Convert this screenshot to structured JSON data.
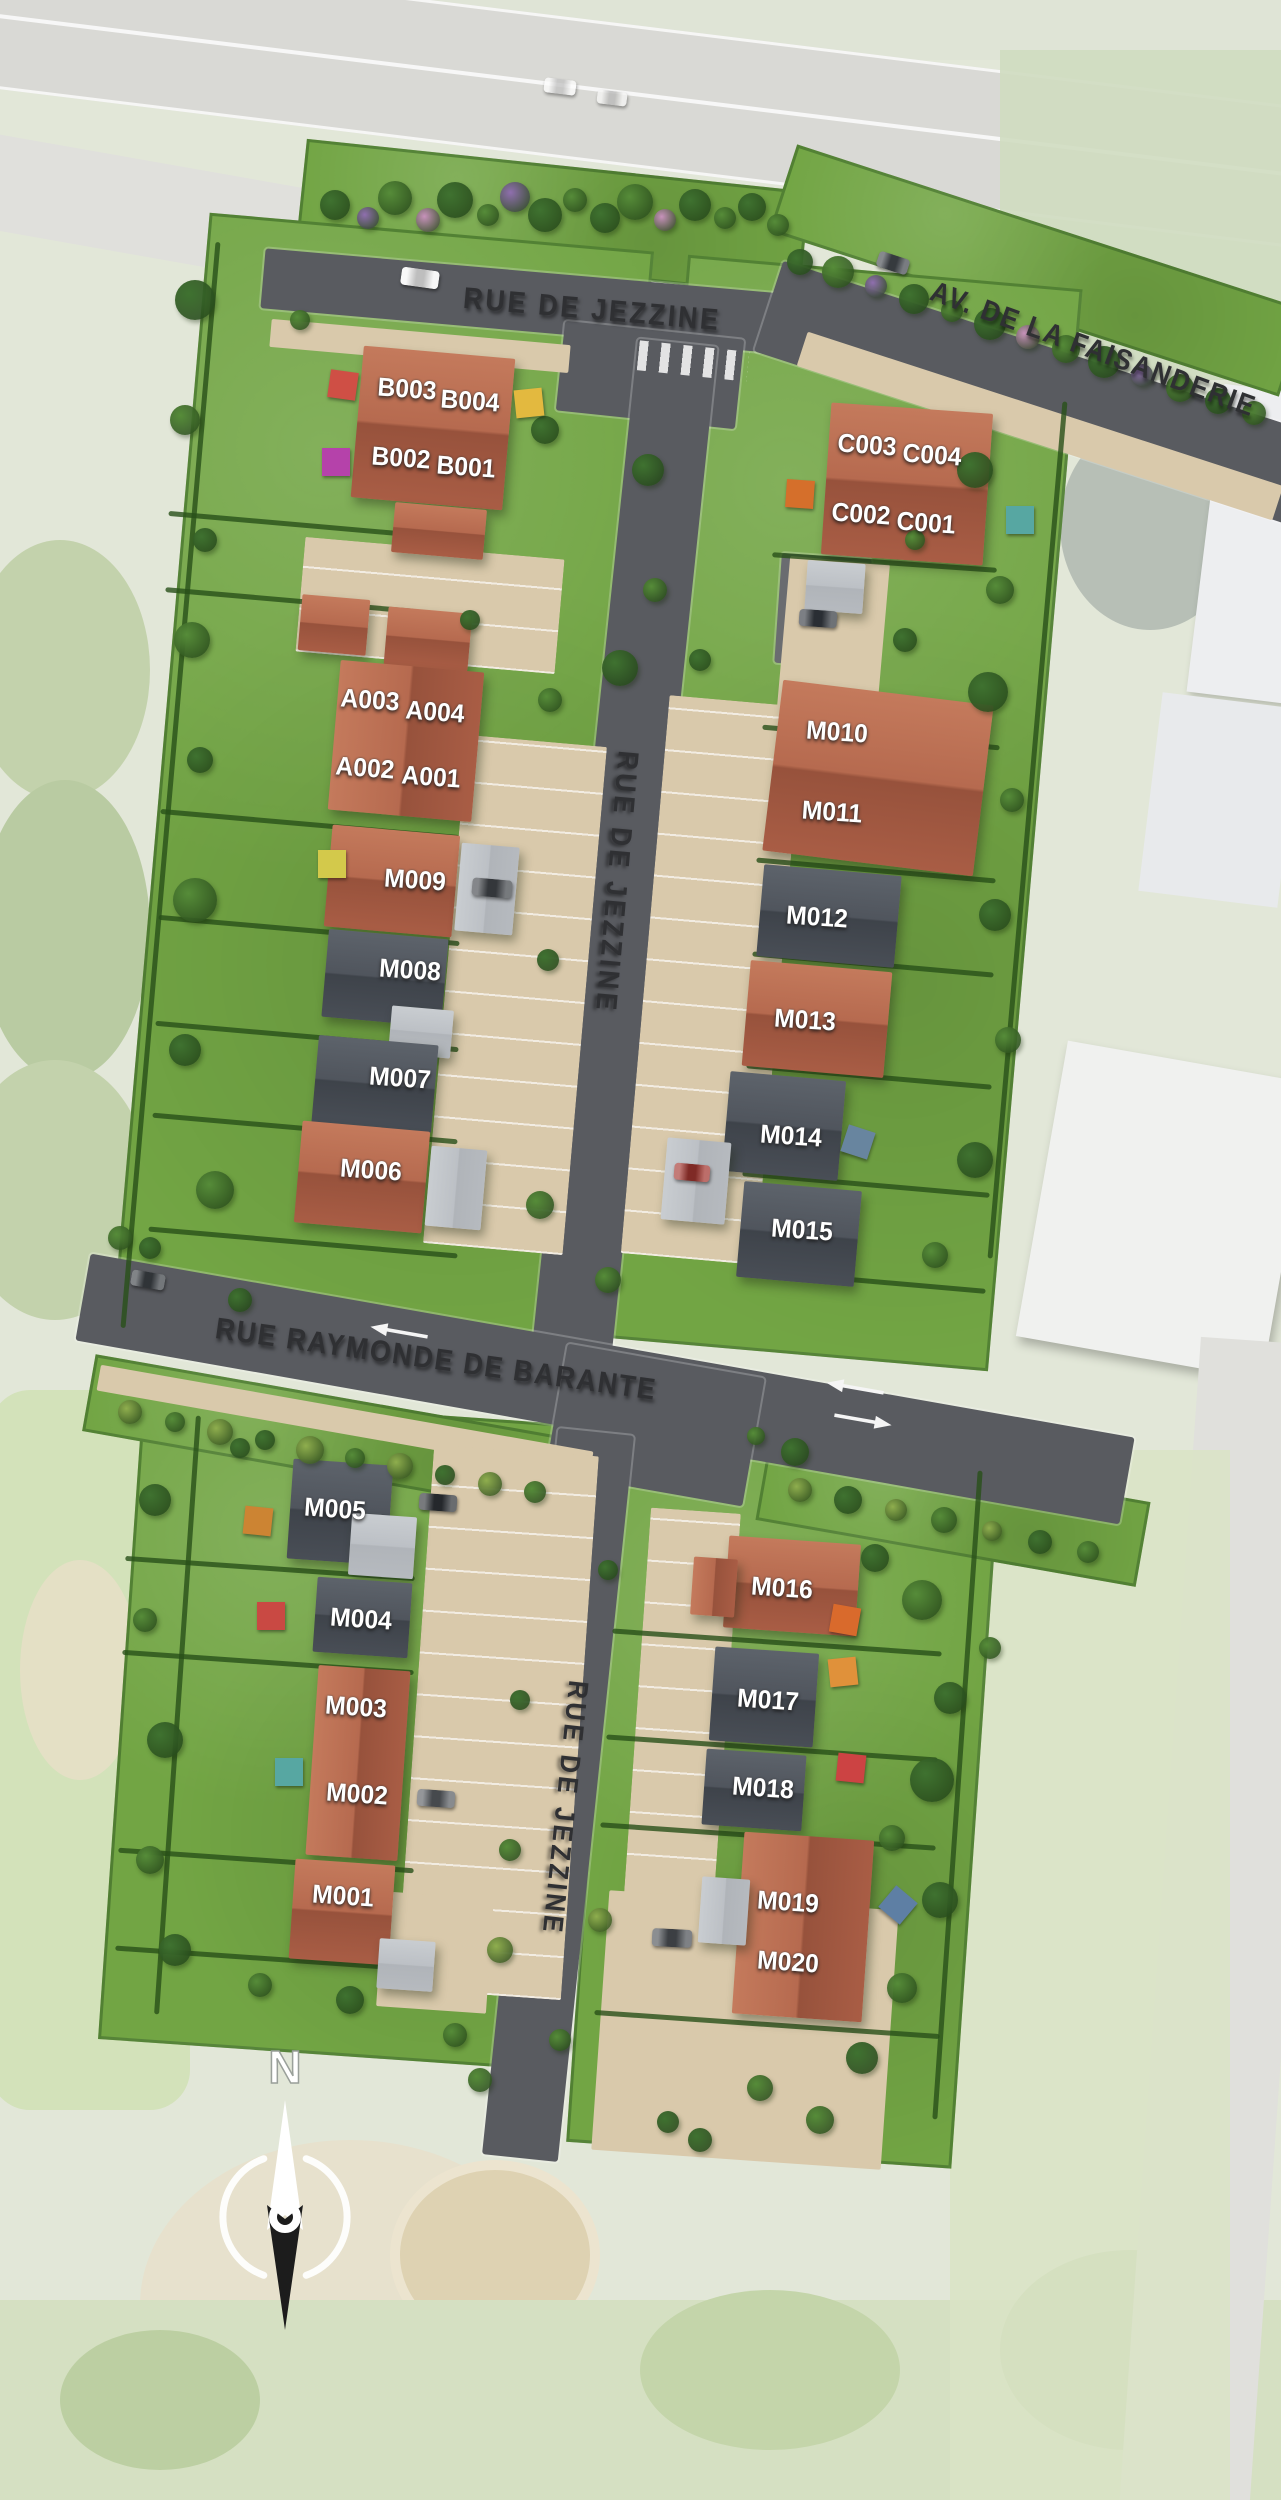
{
  "streets": [
    {
      "id": "rue-de-jezzine-top",
      "label": "RUE DE JEZZINE",
      "x": 592,
      "y": 310,
      "rot": 5,
      "size": 30,
      "ls": 3
    },
    {
      "id": "av-de-la-faisanderie",
      "label": "AV. DE LA  FAISANDERIE",
      "x": 1093,
      "y": 350,
      "rot": 20,
      "size": 29,
      "ls": 2
    },
    {
      "id": "rue-de-jezzine-upper",
      "label": "RUE DE JEZZINE",
      "x": 616,
      "y": 882,
      "rot": 95,
      "size": 29,
      "ls": 4
    },
    {
      "id": "rue-raymonde-de-barante",
      "label": "RUE RAYMONDE DE BARANTE",
      "x": 436,
      "y": 1360,
      "rot": 8,
      "size": 30,
      "ls": 2
    },
    {
      "id": "rue-de-jezzine-lower",
      "label": "RUE DE JEZZINE",
      "x": 565,
      "y": 1808,
      "rot": 96,
      "size": 28,
      "ls": 4
    }
  ],
  "lots": [
    {
      "id": "B003",
      "x": 407,
      "y": 389
    },
    {
      "id": "B004",
      "x": 470,
      "y": 401
    },
    {
      "id": "B002",
      "x": 401,
      "y": 458
    },
    {
      "id": "B001",
      "x": 466,
      "y": 467
    },
    {
      "id": "C003",
      "x": 867,
      "y": 445
    },
    {
      "id": "C004",
      "x": 932,
      "y": 455
    },
    {
      "id": "C002",
      "x": 861,
      "y": 514
    },
    {
      "id": "C001",
      "x": 926,
      "y": 523
    },
    {
      "id": "A003",
      "x": 370,
      "y": 700
    },
    {
      "id": "A004",
      "x": 435,
      "y": 712
    },
    {
      "id": "A002",
      "x": 365,
      "y": 768
    },
    {
      "id": "A001",
      "x": 431,
      "y": 777
    },
    {
      "id": "M010",
      "x": 837,
      "y": 732
    },
    {
      "id": "M011",
      "x": 832,
      "y": 812
    },
    {
      "id": "M009",
      "x": 415,
      "y": 880
    },
    {
      "id": "M008",
      "x": 410,
      "y": 970
    },
    {
      "id": "M012",
      "x": 817,
      "y": 917
    },
    {
      "id": "M013",
      "x": 805,
      "y": 1020
    },
    {
      "id": "M007",
      "x": 400,
      "y": 1078
    },
    {
      "id": "M006",
      "x": 371,
      "y": 1170
    },
    {
      "id": "M014",
      "x": 791,
      "y": 1136
    },
    {
      "id": "M015",
      "x": 802,
      "y": 1230
    },
    {
      "id": "M005",
      "x": 335,
      "y": 1509
    },
    {
      "id": "M004",
      "x": 361,
      "y": 1619
    },
    {
      "id": "M003",
      "x": 356,
      "y": 1707
    },
    {
      "id": "M002",
      "x": 357,
      "y": 1794
    },
    {
      "id": "M001",
      "x": 343,
      "y": 1896
    },
    {
      "id": "M016",
      "x": 782,
      "y": 1588
    },
    {
      "id": "M017",
      "x": 768,
      "y": 1700
    },
    {
      "id": "M018",
      "x": 763,
      "y": 1788
    },
    {
      "id": "M019",
      "x": 788,
      "y": 1902
    },
    {
      "id": "M020",
      "x": 788,
      "y": 1962
    }
  ],
  "buildings": [
    {
      "id": "B",
      "x": 357,
      "y": 352,
      "w": 152,
      "h": 152,
      "t": "terra",
      "r": 5
    },
    {
      "id": "B-garage",
      "x": 393,
      "y": 506,
      "w": 92,
      "h": 50,
      "t": "terra",
      "r": 5
    },
    {
      "id": "A-annex-1",
      "x": 300,
      "y": 597,
      "w": 68,
      "h": 56,
      "t": "terra",
      "r": 5
    },
    {
      "id": "A-annex-2",
      "x": 386,
      "y": 610,
      "w": 84,
      "h": 58,
      "t": "terra",
      "r": 5
    },
    {
      "id": "A",
      "x": 334,
      "y": 666,
      "w": 144,
      "h": 150,
      "t": "terra",
      "r": 5
    },
    {
      "id": "M009",
      "x": 328,
      "y": 830,
      "w": 128,
      "h": 102,
      "t": "terra",
      "r": 5
    },
    {
      "id": "M009-carport",
      "x": 458,
      "y": 845,
      "w": 58,
      "h": 88,
      "t": "annex",
      "r": 5
    },
    {
      "id": "M008",
      "x": 325,
      "y": 934,
      "w": 120,
      "h": 88,
      "t": "slate",
      "r": 5
    },
    {
      "id": "M008-link",
      "x": 390,
      "y": 1008,
      "w": 62,
      "h": 48,
      "t": "annex",
      "r": 5
    },
    {
      "id": "M007",
      "x": 315,
      "y": 1040,
      "w": 120,
      "h": 88,
      "t": "slate",
      "r": 5
    },
    {
      "id": "M006",
      "x": 298,
      "y": 1126,
      "w": 128,
      "h": 102,
      "t": "terra",
      "r": 5
    },
    {
      "id": "M006-carport",
      "x": 428,
      "y": 1148,
      "w": 56,
      "h": 80,
      "t": "annex",
      "r": 5
    },
    {
      "id": "C",
      "x": 826,
      "y": 408,
      "w": 162,
      "h": 152,
      "t": "terra",
      "r": 4
    },
    {
      "id": "C-carport",
      "x": 806,
      "y": 562,
      "w": 58,
      "h": 50,
      "t": "annex",
      "r": 4
    },
    {
      "id": "M010-M011",
      "x": 772,
      "y": 692,
      "w": 212,
      "h": 172,
      "t": "terra",
      "r": 7
    },
    {
      "id": "M012",
      "x": 760,
      "y": 870,
      "w": 138,
      "h": 92,
      "t": "slate",
      "r": 5
    },
    {
      "id": "M013",
      "x": 746,
      "y": 966,
      "w": 142,
      "h": 106,
      "t": "terra",
      "r": 5
    },
    {
      "id": "M014",
      "x": 726,
      "y": 1076,
      "w": 116,
      "h": 100,
      "t": "slate",
      "r": 5
    },
    {
      "id": "M014-carport",
      "x": 664,
      "y": 1140,
      "w": 64,
      "h": 82,
      "t": "annex",
      "r": 5
    },
    {
      "id": "M015",
      "x": 740,
      "y": 1186,
      "w": 118,
      "h": 96,
      "t": "slate",
      "r": 5
    },
    {
      "id": "M005",
      "x": 290,
      "y": 1462,
      "w": 100,
      "h": 100,
      "t": "slate",
      "r": 4
    },
    {
      "id": "M005-link",
      "x": 350,
      "y": 1515,
      "w": 65,
      "h": 62,
      "t": "annex",
      "r": 4
    },
    {
      "id": "M004",
      "x": 315,
      "y": 1580,
      "w": 95,
      "h": 75,
      "t": "slate",
      "r": 4
    },
    {
      "id": "M003-M002",
      "x": 312,
      "y": 1668,
      "w": 92,
      "h": 190,
      "t": "terra",
      "r": 4
    },
    {
      "id": "M001",
      "x": 292,
      "y": 1862,
      "w": 100,
      "h": 100,
      "t": "terra",
      "r": 4
    },
    {
      "id": "M001-link",
      "x": 378,
      "y": 1940,
      "w": 56,
      "h": 50,
      "t": "annex",
      "r": 4
    },
    {
      "id": "M016",
      "x": 726,
      "y": 1540,
      "w": 132,
      "h": 92,
      "t": "terra",
      "r": 4
    },
    {
      "id": "M016-garage",
      "x": 692,
      "y": 1558,
      "w": 44,
      "h": 58,
      "t": "terra",
      "r": 4
    },
    {
      "id": "M017",
      "x": 712,
      "y": 1650,
      "w": 104,
      "h": 94,
      "t": "slate",
      "r": 4
    },
    {
      "id": "M018",
      "x": 704,
      "y": 1752,
      "w": 100,
      "h": 76,
      "t": "slate",
      "r": 4
    },
    {
      "id": "M019-M020",
      "x": 738,
      "y": 1836,
      "w": 130,
      "h": 182,
      "t": "terra",
      "r": 4
    },
    {
      "id": "M019-garage",
      "x": 700,
      "y": 1878,
      "w": 48,
      "h": 66,
      "t": "annex",
      "r": 4
    }
  ],
  "parasols": [
    {
      "x": 343,
      "y": 385,
      "c": "#cf4f45",
      "r": 8
    },
    {
      "x": 529,
      "y": 403,
      "c": "#e3b93f",
      "r": -6
    },
    {
      "x": 336,
      "y": 462,
      "c": "#b542aa",
      "r": 0
    },
    {
      "x": 800,
      "y": 494,
      "c": "#d56f2b",
      "r": 4
    },
    {
      "x": 1020,
      "y": 520,
      "c": "#57a7a2",
      "r": 0
    },
    {
      "x": 332,
      "y": 864,
      "c": "#d3c94b",
      "r": 0
    },
    {
      "x": 858,
      "y": 1142,
      "c": "#68859f",
      "r": 18
    },
    {
      "x": 258,
      "y": 1521,
      "c": "#cc8433",
      "r": 6
    },
    {
      "x": 271,
      "y": 1616,
      "c": "#c94943",
      "r": 0
    },
    {
      "x": 289,
      "y": 1772,
      "c": "#57a7a2",
      "r": 0
    },
    {
      "x": 845,
      "y": 1620,
      "c": "#d96a2c",
      "r": 10
    },
    {
      "x": 843,
      "y": 1672,
      "c": "#e0913a",
      "r": -6
    },
    {
      "x": 851,
      "y": 1768,
      "c": "#cc4343",
      "r": 6
    },
    {
      "x": 898,
      "y": 1905,
      "c": "#5e7fa4",
      "r": 40
    }
  ],
  "cars": [
    {
      "x": 420,
      "y": 278,
      "w": 38,
      "h": 18,
      "c": "#f4f4f4",
      "r": 8
    },
    {
      "x": 893,
      "y": 263,
      "w": 32,
      "h": 16,
      "c": "#454a50",
      "r": 18
    },
    {
      "x": 818,
      "y": 618,
      "w": 38,
      "h": 17,
      "c": "#363b42",
      "r": 4
    },
    {
      "x": 492,
      "y": 888,
      "w": 40,
      "h": 18,
      "c": "#42464b",
      "r": 5
    },
    {
      "x": 692,
      "y": 1172,
      "w": 36,
      "h": 17,
      "c": "#a33630",
      "r": 5
    },
    {
      "x": 438,
      "y": 1502,
      "w": 38,
      "h": 17,
      "c": "#2f3338",
      "r": 4
    },
    {
      "x": 436,
      "y": 1798,
      "w": 38,
      "h": 17,
      "c": "#5a5e63",
      "r": 4
    },
    {
      "x": 672,
      "y": 1938,
      "w": 40,
      "h": 18,
      "c": "#4d5156",
      "r": 3
    },
    {
      "x": 148,
      "y": 1280,
      "w": 34,
      "h": 16,
      "c": "#3d4247",
      "r": 10
    },
    {
      "x": 560,
      "y": 86,
      "w": 32,
      "h": 15,
      "c": "#fbfbfb",
      "r": 7,
      "o": 0.8
    },
    {
      "x": 612,
      "y": 98,
      "w": 30,
      "h": 14,
      "c": "#f0f0ee",
      "r": 7,
      "o": 0.8
    }
  ],
  "arrows": [
    {
      "x": 400,
      "y": 1332,
      "r": 10,
      "dir": "left"
    },
    {
      "x": 856,
      "y": 1388,
      "r": 10,
      "dir": "left"
    },
    {
      "x": 862,
      "y": 1420,
      "r": 10,
      "dir": "right"
    }
  ],
  "compass": {
    "north_label": "N"
  },
  "colors": {
    "grass": "#72a544",
    "road": "#595b60",
    "parking": "#d9c9ab",
    "roof_terracotta": "#b2604a",
    "roof_slate": "#4d525a",
    "lot_text": "#ffffff",
    "street_text": "#2f3033"
  }
}
